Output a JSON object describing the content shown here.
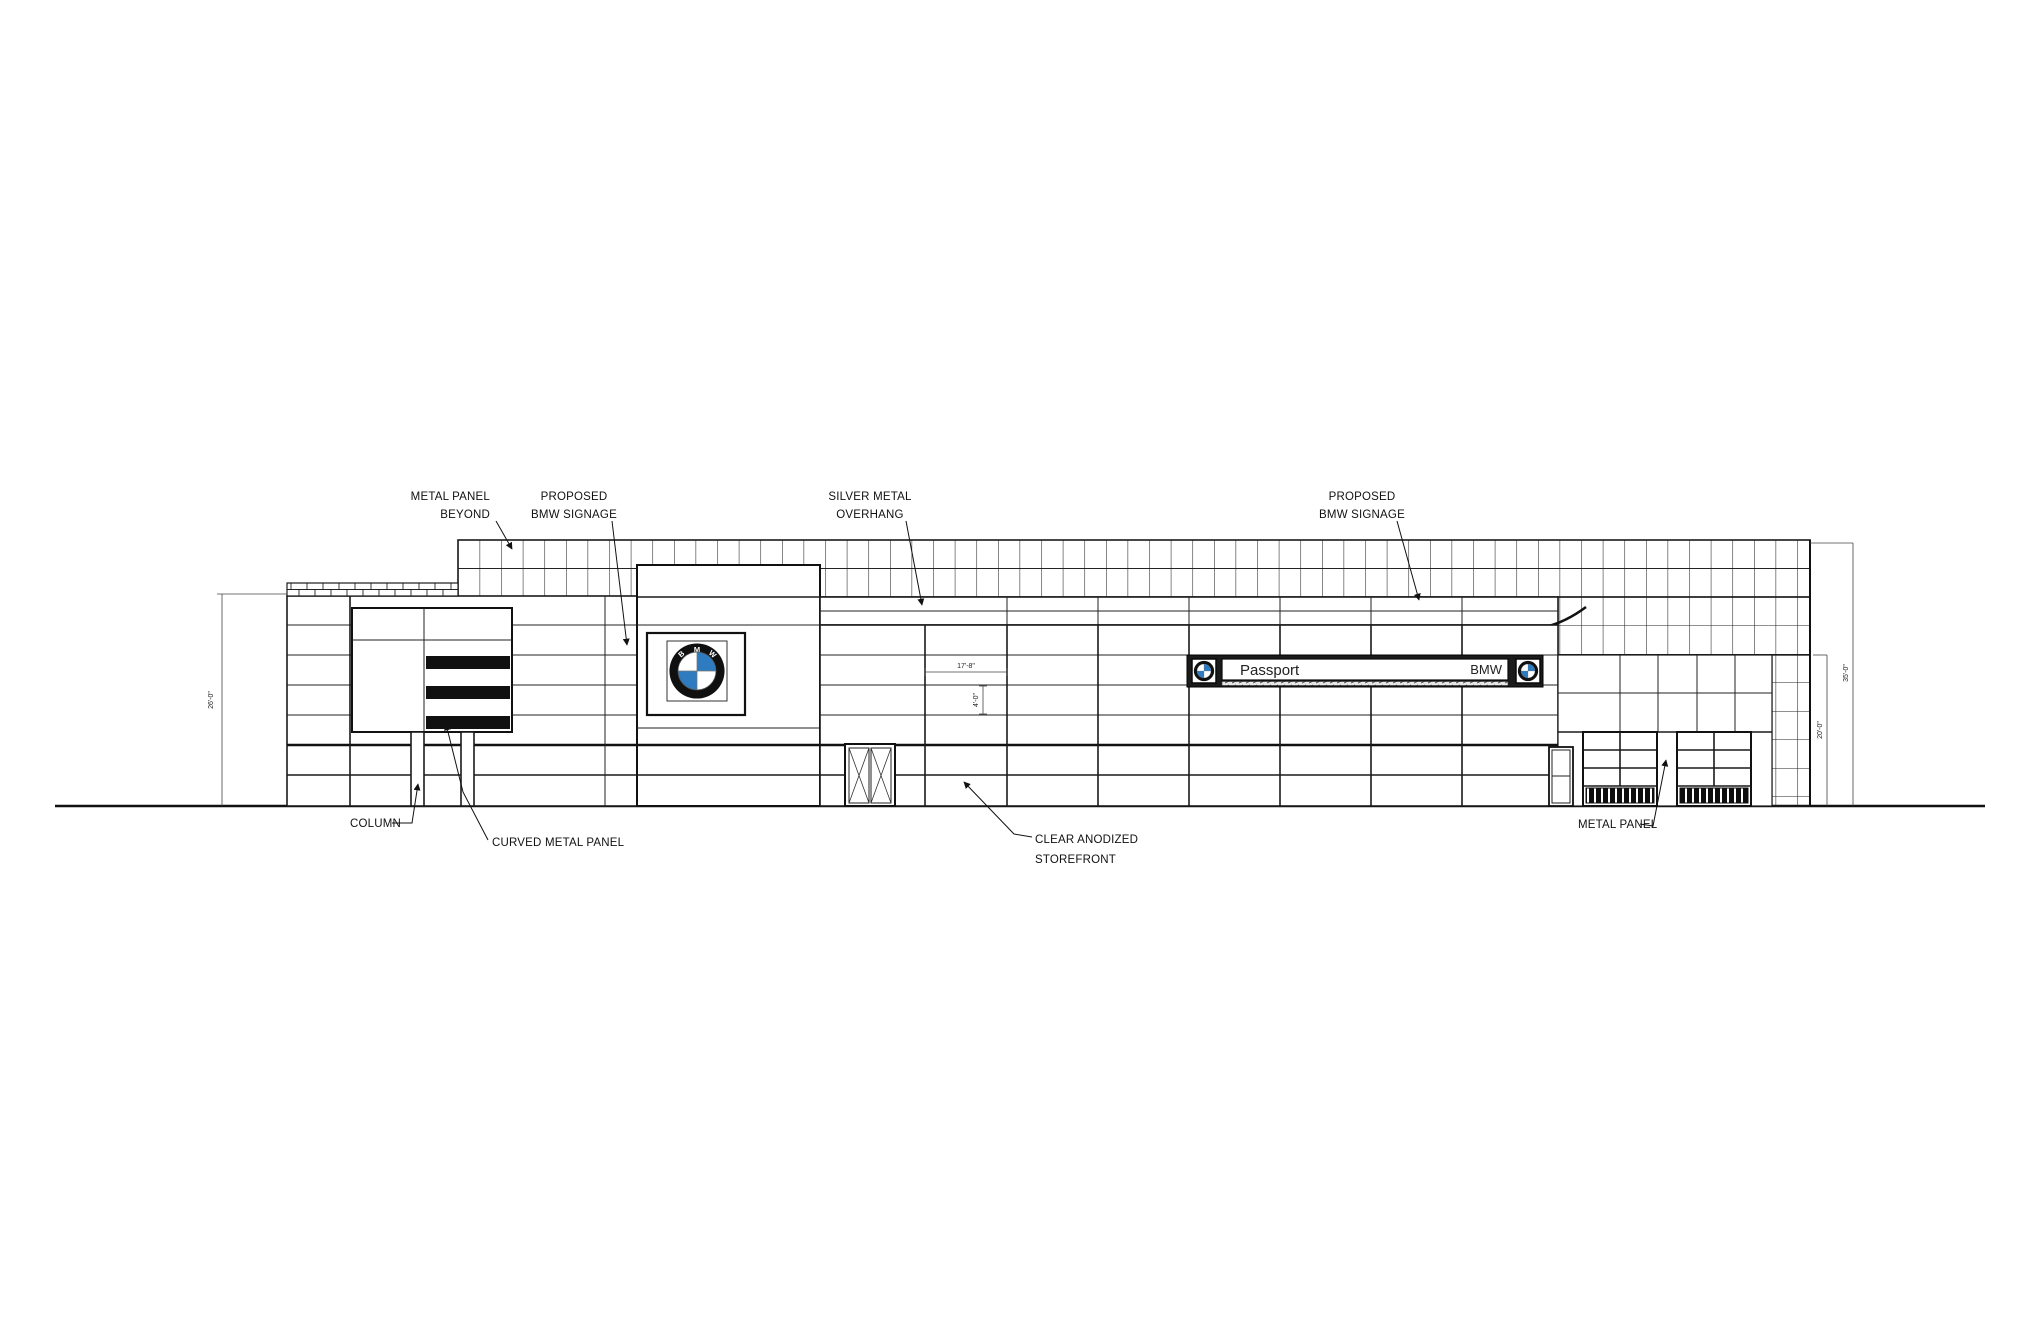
{
  "labels": {
    "metal_panel_beyond": {
      "line1": "METAL PANEL",
      "line2": "BEYOND"
    },
    "proposed_bmw_signage_left": {
      "line1": "PROPOSED",
      "line2": "BMW SIGNAGE"
    },
    "silver_metal_overhang": {
      "line1": "SILVER METAL",
      "line2": "OVERHANG"
    },
    "proposed_bmw_signage_right": {
      "line1": "PROPOSED",
      "line2": "BMW SIGNAGE"
    },
    "column": "COLUMN",
    "curved_metal_panel": "CURVED METAL PANEL",
    "clear_anodized_storefront": {
      "line1": "CLEAR ANODIZED",
      "line2": "STOREFRONT"
    },
    "metal_panel_right": "METAL PANEL"
  },
  "dimensions": {
    "left_building_height": "26'-0\"",
    "sign_band_width": "17'-8\"",
    "sign_band_height": "4'-0\"",
    "right_overall_height": "35'-0\"",
    "right_lower_height": "20'-0\""
  },
  "signage": {
    "dealer_sign": {
      "name": "Passport",
      "brand": "BMW"
    },
    "bmw_roundel_letters": {
      "b": "B",
      "m": "M",
      "w": "W"
    }
  },
  "colors": {
    "line": "#1a1a1a",
    "bmw_blue": "#2f7bc0",
    "sign_frame": "#1b1b1b"
  }
}
